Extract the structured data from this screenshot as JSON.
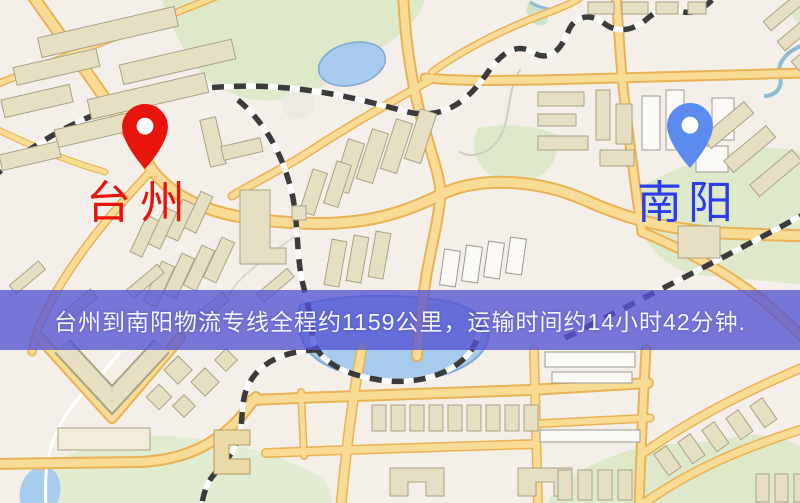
{
  "image": {
    "type": "logistics-route-map",
    "width_px": 800,
    "height_px": 503
  },
  "markers": {
    "origin": {
      "label": "台州",
      "pin": "red-pin-icon",
      "pin_color": "#e8150d",
      "label_color": "#e8130b"
    },
    "destination": {
      "label": "南阳",
      "pin": "blue-pin-icon",
      "pin_color": "#5b8bef",
      "label_color": "#2b3cf0"
    }
  },
  "banner": {
    "text": "台州到南阳物流专线全程约1159公里，运输时间约14小时42分钟.",
    "bg_color": "#5252d4",
    "text_color": "#f5f5fb",
    "route": {
      "origin": "台州",
      "destination": "南阳",
      "service": "物流专线",
      "distance": "约1159公里",
      "duration": "约14小时42分钟"
    }
  },
  "map_style": {
    "background": "#f4f0e9",
    "road_fill": "#f8dc96",
    "road_edge": "#eab254",
    "building": "#e7dfc2",
    "building_light": "#fbfaf6",
    "park": "#dde9c9",
    "water": "#a7cbec",
    "railway": "#3b3b3b"
  }
}
